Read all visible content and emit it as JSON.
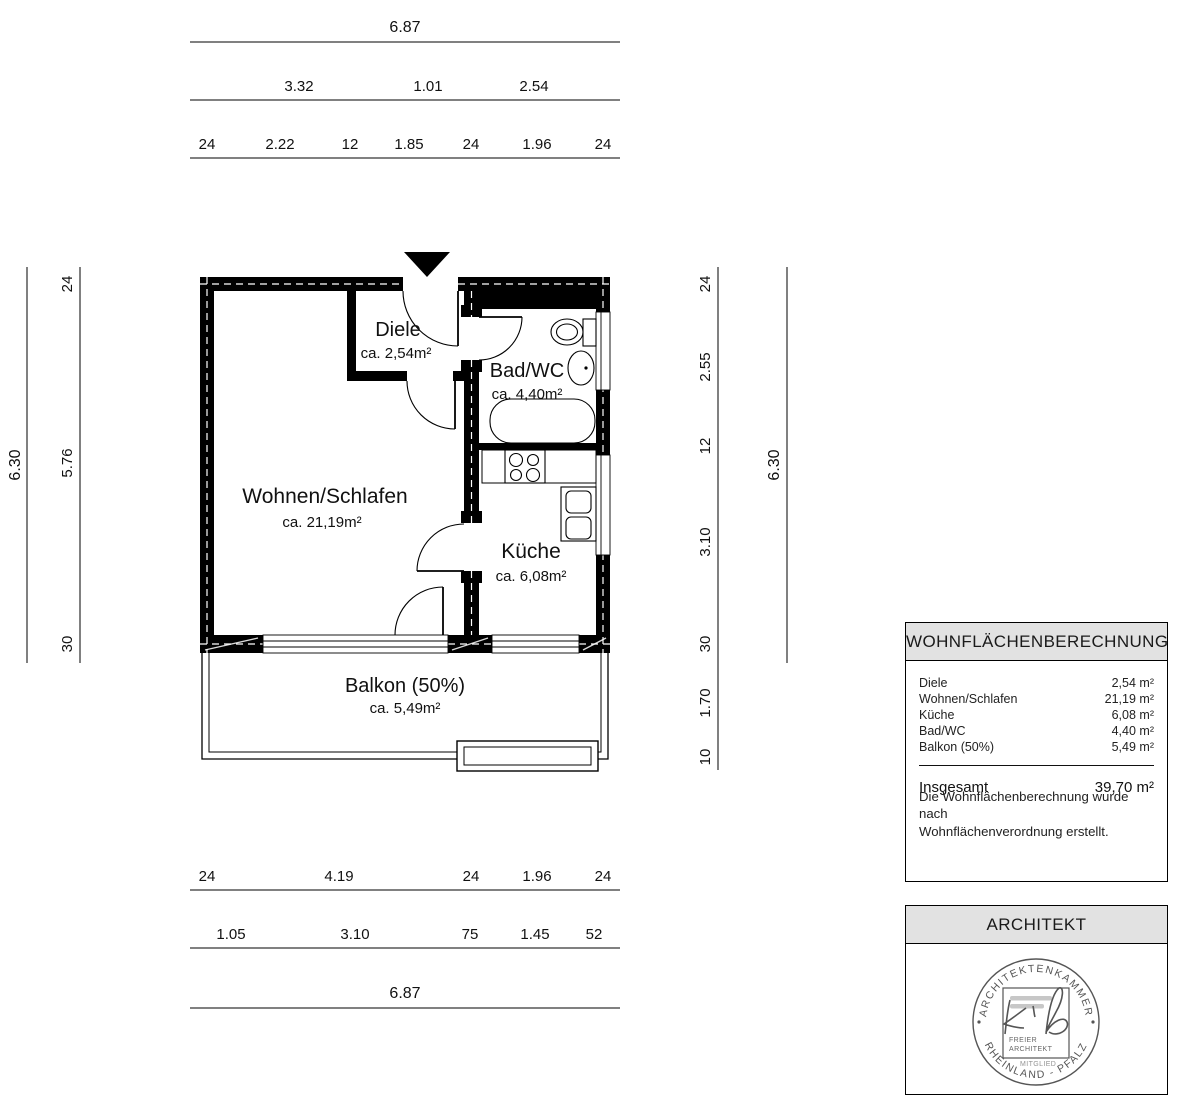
{
  "rooms": {
    "diele": {
      "name": "Diele",
      "area": "ca. 2,54m²"
    },
    "bad": {
      "name": "Bad/WC",
      "area": "ca. 4,40m²"
    },
    "wohnen": {
      "name": "Wohnen/Schlafen",
      "area": "ca. 21,19m²"
    },
    "kueche": {
      "name": "Küche",
      "area": "ca. 6,08m²"
    },
    "balkon": {
      "name": "Balkon (50%)",
      "area": "ca. 5,49m²"
    }
  },
  "dims": {
    "top": {
      "row1": [
        "6.87"
      ],
      "row2": [
        "3.32",
        "1.01",
        "2.54"
      ],
      "row3": [
        "24",
        "2.22",
        "12",
        "1.85",
        "24",
        "1.96",
        "24"
      ]
    },
    "bottom": {
      "row1": [
        "24",
        "4.19",
        "24",
        "1.96",
        "24"
      ],
      "row2": [
        "1.05",
        "3.10",
        "75",
        "1.45",
        "52"
      ],
      "row3": [
        "6.87"
      ]
    },
    "left": {
      "outer": "6.30",
      "inner": [
        "24",
        "5.76",
        "30"
      ]
    },
    "right": {
      "inner": [
        "24",
        "2.55",
        "12",
        "3.10",
        "30",
        "1.70",
        "10"
      ],
      "outer": "6.30"
    }
  },
  "area_table": {
    "title": "WOHNFLÄCHENBERECHNUNG",
    "rows": [
      {
        "label": "Diele",
        "value": "2,54 m²"
      },
      {
        "label": "Wohnen/Schlafen",
        "value": "21,19 m²"
      },
      {
        "label": "Küche",
        "value": "6,08 m²"
      },
      {
        "label": "Bad/WC",
        "value": "4,40 m²"
      },
      {
        "label": "Balkon (50%)",
        "value": "5,49 m²"
      }
    ],
    "total_label": "Insgesamt",
    "total_value": "39,70 m²",
    "note_line1": "Die Wohnflächenberechnung wurde nach",
    "note_line2": "Wohnflächenverordnung erstellt."
  },
  "architect": {
    "title": "ARCHITEKT",
    "stamp": {
      "ring_top": "ARCHITEKTENKAMMER",
      "ring_bottom": "RHEINLAND - PFALZ",
      "inner_line1": "FREIER",
      "inner_line2": "ARCHITEKT",
      "inner_line3": "MITGLIED"
    }
  },
  "colors": {
    "wall": "#000000",
    "panel_header_bg": "#e2e2e2",
    "stamp": "#555555"
  }
}
